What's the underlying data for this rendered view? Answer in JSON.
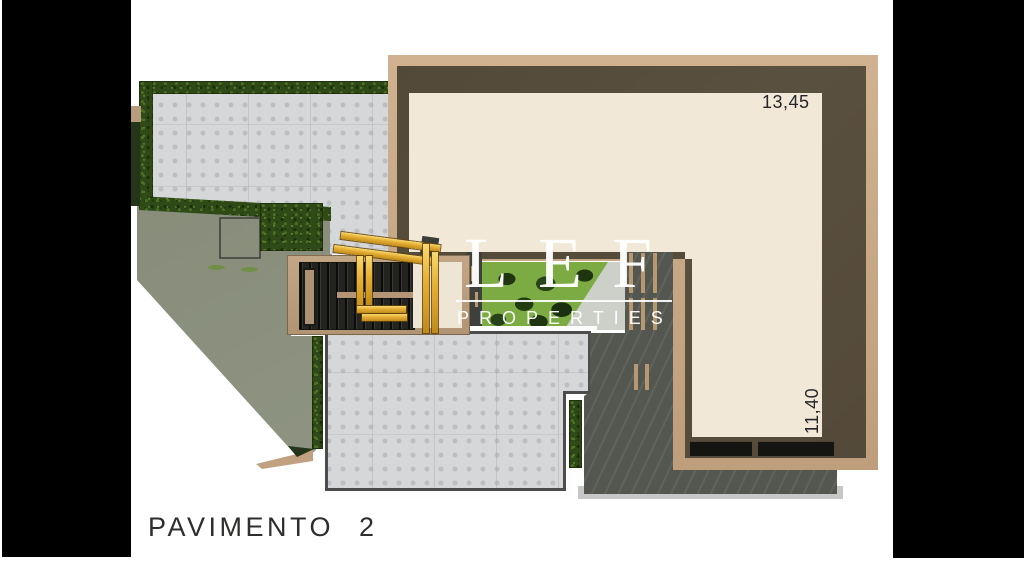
{
  "page": {
    "width": 1024,
    "height": 562,
    "background": "#ffffff"
  },
  "plan": {
    "floor_label": "PAVIMENTO 2",
    "dim_top": "13,45",
    "dim_right": "11,40"
  },
  "watermark": {
    "brand": "LEF",
    "tagline": "PROPERTIES",
    "color": "#ffffff",
    "logo_mark": "lef-gold-monogram"
  },
  "palette": {
    "letterbox": "#000000",
    "roof_tan": "#c8a987",
    "roof_brown": "#544a39",
    "floor_cream": "#f1e8d7",
    "paver_gray": "#d5d6d7",
    "hedge_green": "#2f4a17",
    "lawn_green": "#7cab43",
    "terrain_olive": "#8b9080",
    "deck_gray": "#575a52",
    "gold": "#e3ac2e",
    "label_ink": "#2b2b28"
  }
}
